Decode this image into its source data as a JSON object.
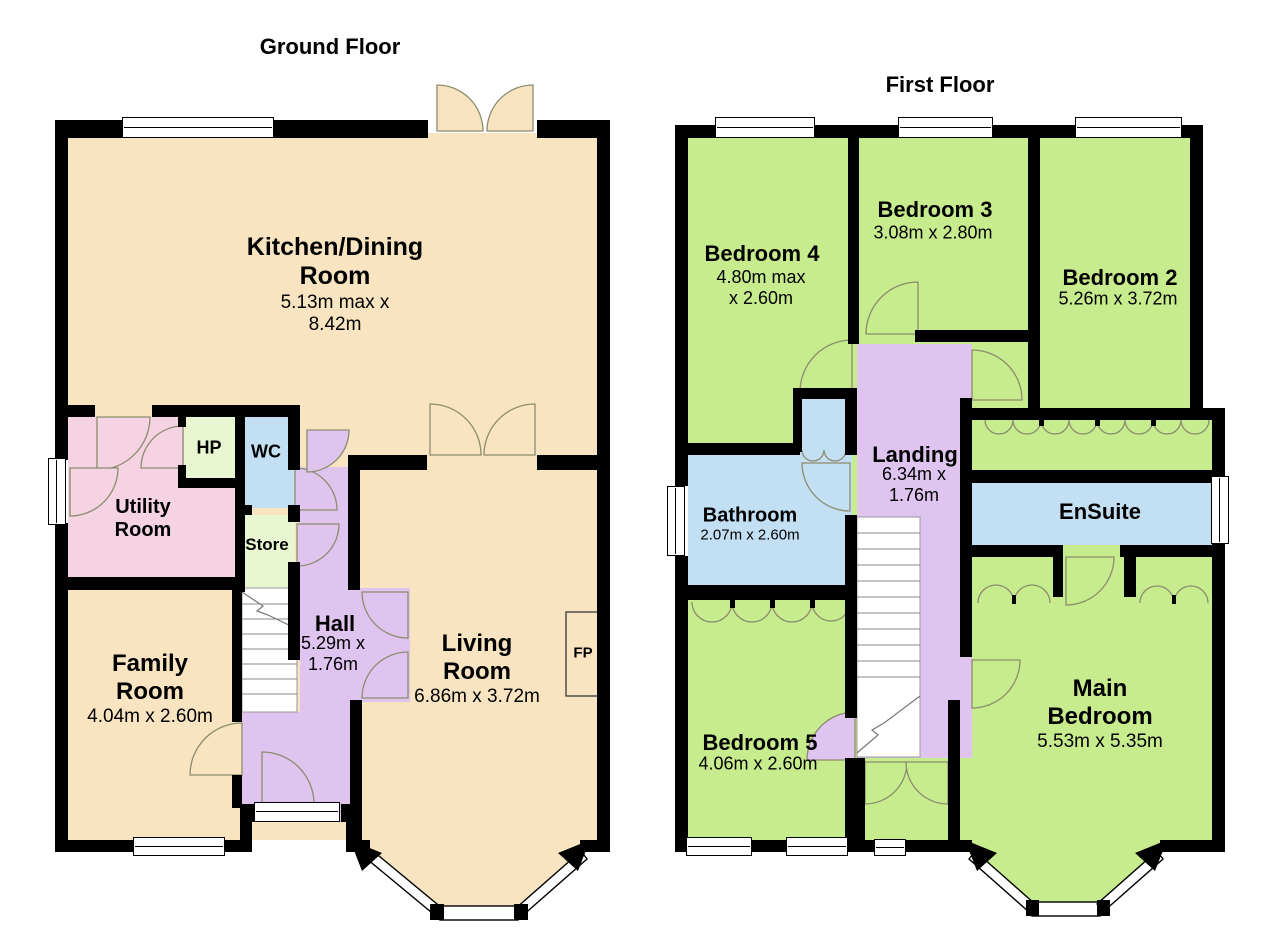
{
  "ground_floor": {
    "title": "Ground Floor",
    "rooms": {
      "kitchen": {
        "name": "Kitchen/Dining Room",
        "dims": "5.13m max x 8.42m"
      },
      "utility": {
        "name": "Utility Room"
      },
      "hp": {
        "name": "HP"
      },
      "wc": {
        "name": "WC"
      },
      "store": {
        "name": "Store"
      },
      "hall": {
        "name": "Hall",
        "dims": "5.29m x 1.76m"
      },
      "family": {
        "name": "Family Room",
        "dims": "4.04m x 2.60m"
      },
      "living": {
        "name": "Living Room",
        "dims": "6.86m x 3.72m"
      },
      "fireplace": {
        "name": "FP"
      }
    }
  },
  "first_floor": {
    "title": "First Floor",
    "rooms": {
      "bedroom4": {
        "name": "Bedroom 4",
        "dims": "4.80m max x 2.60m"
      },
      "bedroom3": {
        "name": "Bedroom 3",
        "dims": "3.08m x 2.80m"
      },
      "bedroom2": {
        "name": "Bedroom 2",
        "dims": "5.26m x 3.72m"
      },
      "landing": {
        "name": "Landing",
        "dims": "6.34m x 1.76m"
      },
      "bathroom": {
        "name": "Bathroom",
        "dims": "2.07m x 2.60m"
      },
      "ensuite": {
        "name": "EnSuite"
      },
      "bedroom5": {
        "name": "Bedroom 5",
        "dims": "4.06m x 2.60m"
      },
      "main_bedroom": {
        "name": "Main Bedroom",
        "dims": "5.53m x 5.35m"
      }
    }
  },
  "colors": {
    "cream": "#F8E4C0",
    "pink": "#F6D3E2",
    "pale_green": "#E9F6D2",
    "pale_blue": "#C3DFF3",
    "purple": "#DFC4F0",
    "green": "#C7EC8D",
    "wall": "#000000",
    "door_arc": "#8C8C6E"
  }
}
